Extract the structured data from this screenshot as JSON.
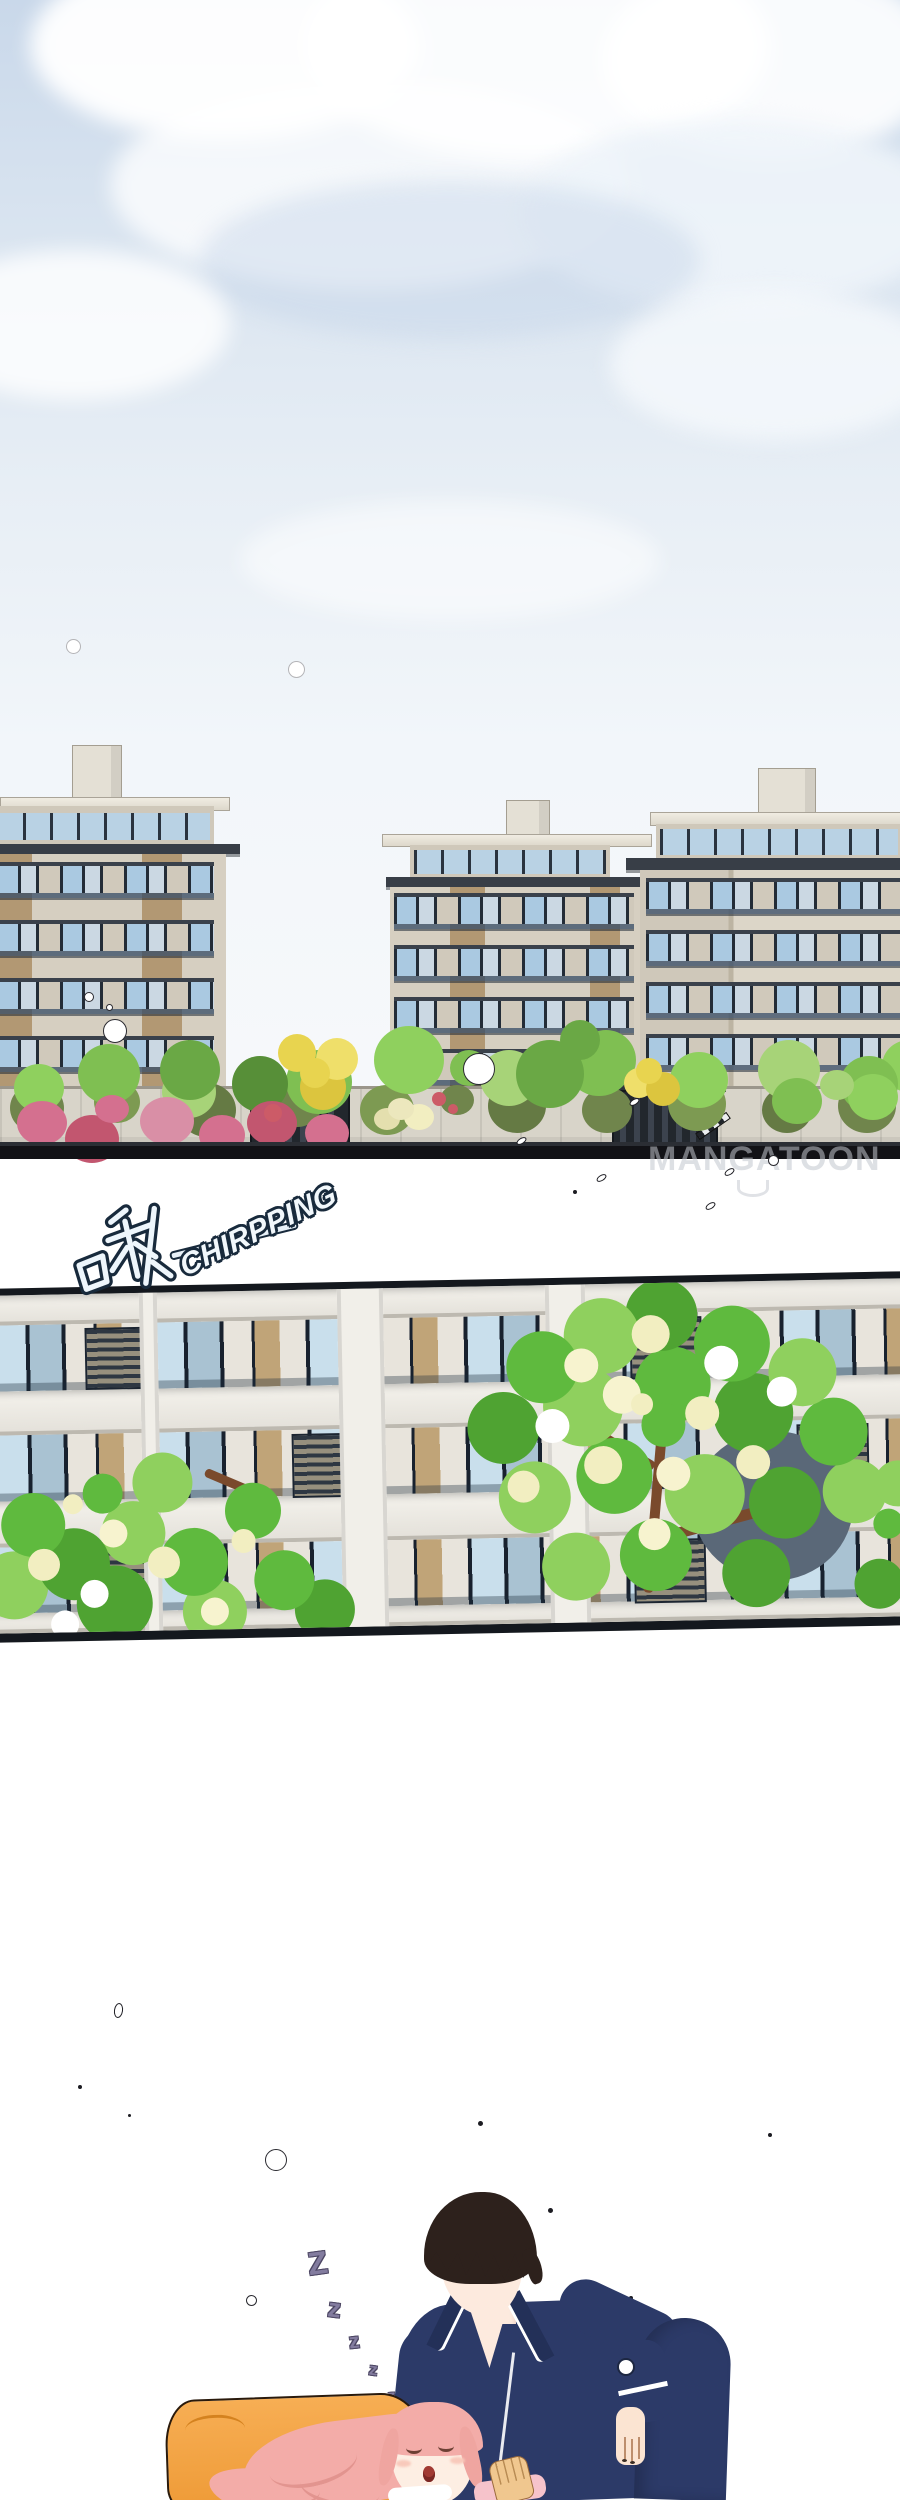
{
  "canvas": {
    "width": 900,
    "height": 2500
  },
  "sfx": {
    "chinese": "啾",
    "english": "CHIRPPING",
    "zzz": [
      "Z",
      "z",
      "z",
      "z",
      "z"
    ]
  },
  "watermark": {
    "text": "MANGATOON"
  },
  "palette": {
    "sky_top": "#c9d8ea",
    "sky_bottom": "#f7f9fb",
    "cloud_white": "#ffffff",
    "cloud_shadow": "#c5d4e6",
    "ink_dark": "#14181e",
    "wall_light": "#d6cfc1",
    "wall_tan": "#b29873",
    "roof_dark": "#383e47",
    "window_blue": "#aac9e1",
    "window_pale": "#cbd8e3",
    "frame_dark": "#1c2531",
    "facade_light": "#ecebe6",
    "facade_panel_tan": "#c0a478",
    "facade_shadow": "#5a6878",
    "leaf_green": "#5fba3e",
    "leaf_light": "#8fd05e",
    "leaf_olive": "#70854c",
    "flower_cream": "#f2eec1",
    "bush_pink": "#d4708f",
    "bush_red": "#c2566f",
    "bush_yellow": "#e8d44f",
    "stone_wall": "#d8d4c9",
    "pillow_orange": "#f3a64b",
    "pajama_navy": "#2c3a68",
    "hair_brown": "#2d211c",
    "hair_pink": "#f3aca8",
    "skin": "#fdeade",
    "zzz_purple": "#837c9f",
    "sfx_fill": "#eef6fc",
    "sfx_outline": "#182a3c",
    "watermark_gray": "#c3c7cf"
  }
}
